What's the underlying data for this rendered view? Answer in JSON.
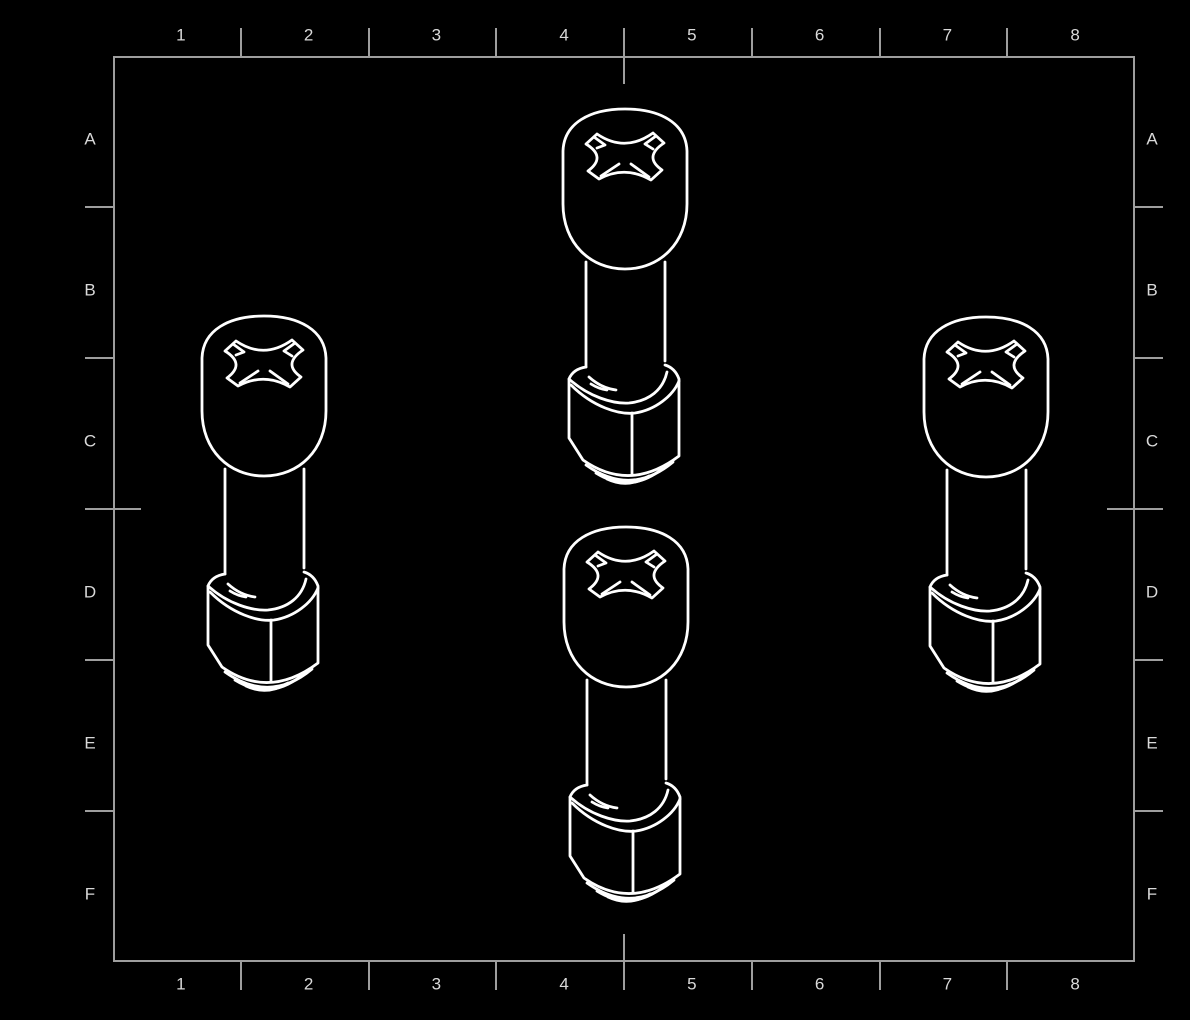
{
  "sheet": {
    "column_labels": [
      "1",
      "2",
      "3",
      "4",
      "5",
      "6",
      "7",
      "8"
    ],
    "row_labels": [
      "A",
      "B",
      "C",
      "D",
      "E",
      "F"
    ],
    "frame": {
      "x": 113,
      "y": 56,
      "width": 1022,
      "height": 906
    },
    "colors": {
      "background": "#000000",
      "border": "#9e9e9e",
      "labels": "#d9d9d9",
      "part_lines": "#ffffff"
    }
  },
  "parts": [
    {
      "name": "part-view-top-center",
      "label": "phillips-pan-head-screw-with-hex-nut",
      "x": 561,
      "y": 107
    },
    {
      "name": "part-view-left",
      "label": "phillips-pan-head-screw-with-hex-nut",
      "x": 200,
      "y": 314
    },
    {
      "name": "part-view-right",
      "label": "phillips-pan-head-screw-with-hex-nut",
      "x": 922,
      "y": 315
    },
    {
      "name": "part-view-bottom-center",
      "label": "phillips-pan-head-screw-with-hex-nut",
      "x": 562,
      "y": 525
    }
  ]
}
